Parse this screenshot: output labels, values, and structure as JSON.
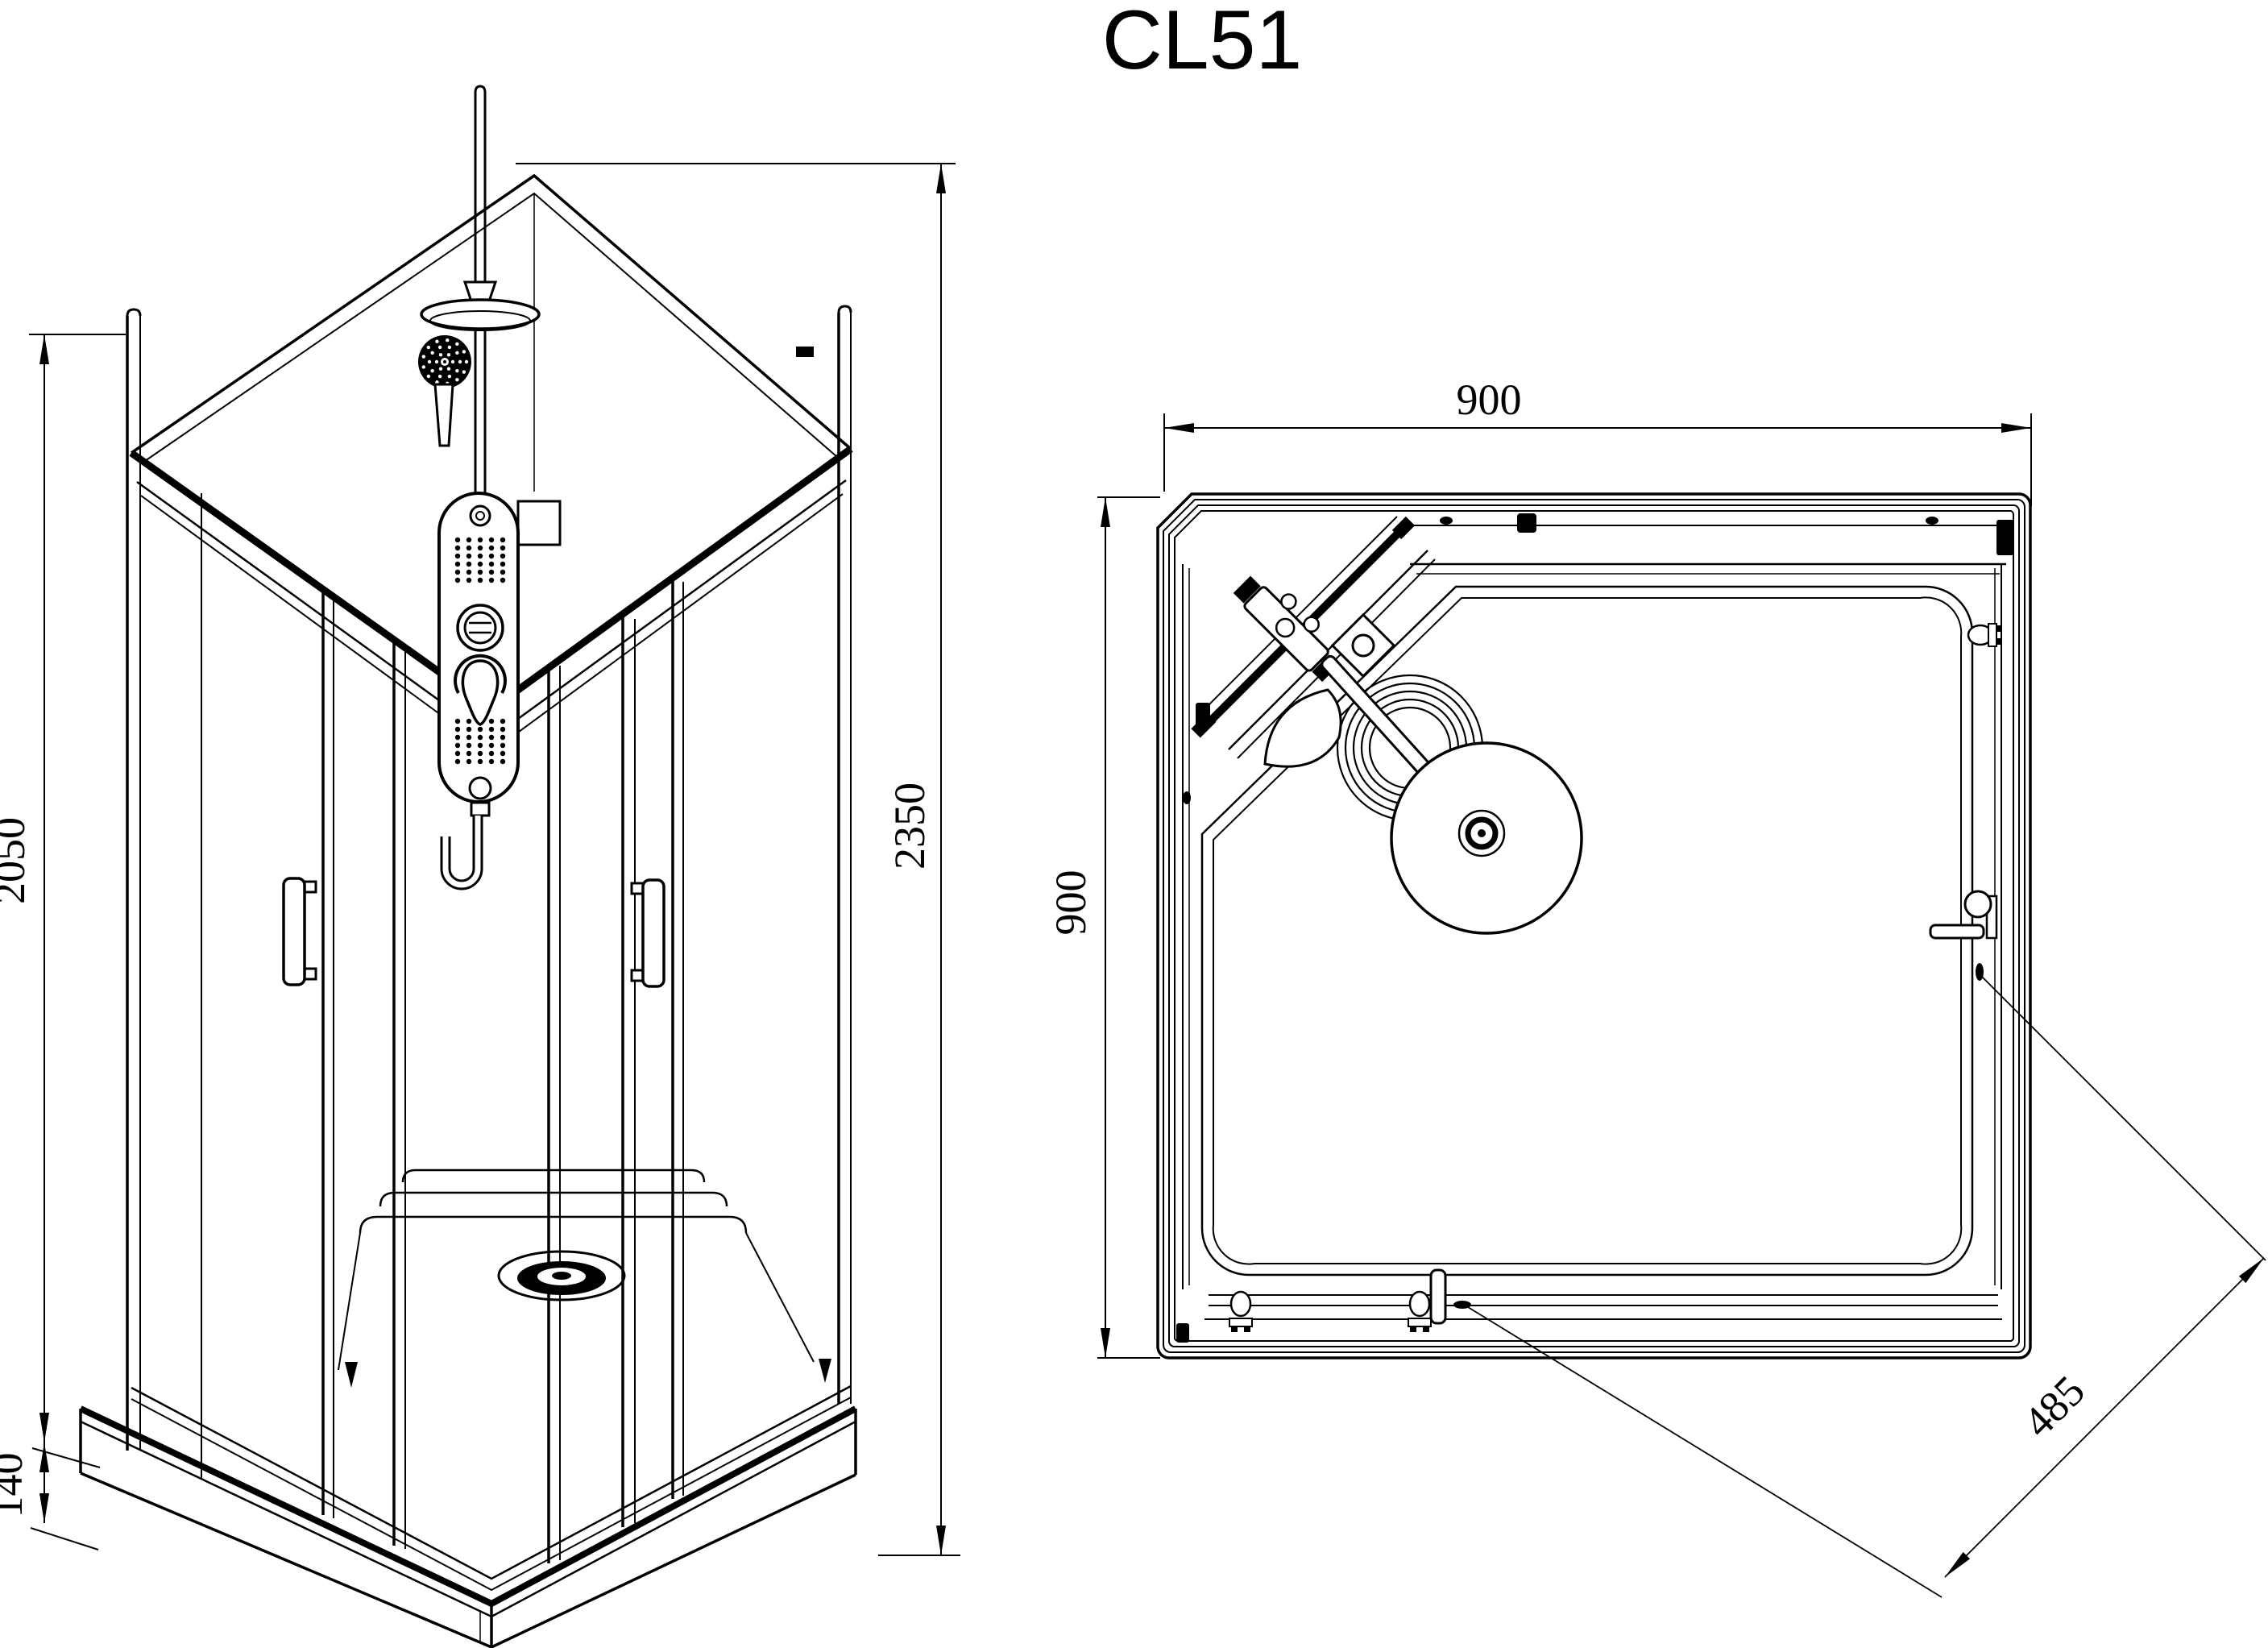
{
  "drawing": {
    "title": "CL51",
    "line_color": "#000000",
    "background_color": "#ffffff",
    "views": {
      "elevation": {
        "name": "front isometric view of shower cabin",
        "dimensions": {
          "overall_height": "2350",
          "cabin_height": "2050",
          "tray_height": "140"
        }
      },
      "plan": {
        "name": "top plan view of shower cabin",
        "dimensions": {
          "outer_width": "900",
          "outer_depth": "900",
          "corner_entry": "485"
        }
      }
    }
  }
}
